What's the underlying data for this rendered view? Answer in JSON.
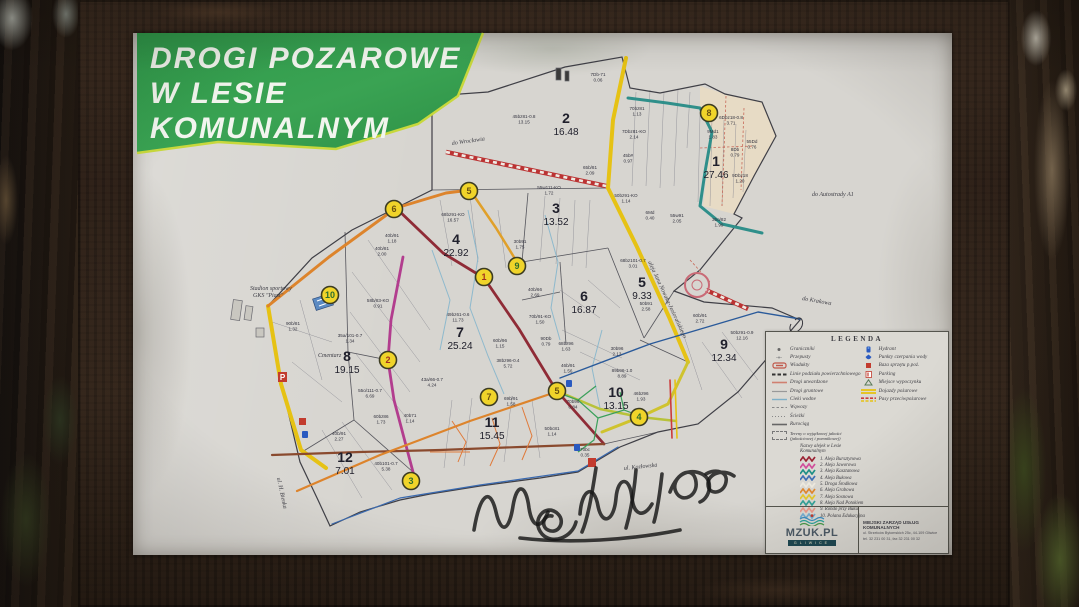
{
  "title": {
    "lines": [
      "DROGI POZAROWE",
      "W LESIE",
      "KOMUNALNYM"
    ]
  },
  "map": {
    "boundary": "488,92 565,67 622,57 630,88 660,93 705,84 725,94 762,102 776,136 754,176 734,214 742,218 700,270 674,291 704,302 772,308 800,320 770,355 738,392 698,424 658,432 620,447 578,472 540,478 480,486 430,494 400,500 360,512 330,526 318,500 300,462 282,386 268,306 312,258 352,230 396,208 432,190 432,96",
    "inner": [
      "432,190 608,188",
      "528,193 522,262",
      "522,262 608,248",
      "608,248 644,338",
      "644,338 674,291",
      "345,232 348,352",
      "348,352 354,420",
      "354,420 302,452",
      "354,420 413,472",
      "348,352 388,360",
      "522,300 560,292",
      "560,262 566,344",
      "604,444 658,432",
      "640,340 688,362"
    ],
    "mesh": [
      [
        636,
        92,
        632,
        186
      ],
      [
        650,
        90,
        646,
        186
      ],
      [
        664,
        92,
        660,
        188
      ],
      [
        678,
        90,
        674,
        186
      ],
      [
        690,
        92,
        687,
        148
      ],
      [
        700,
        115,
        698,
        202
      ],
      [
        712,
        118,
        710,
        206
      ],
      [
        724,
        120,
        722,
        206
      ],
      [
        736,
        124,
        733,
        198
      ],
      [
        746,
        130,
        743,
        192
      ],
      [
        545,
        196,
        540,
        262
      ],
      [
        560,
        198,
        556,
        264
      ],
      [
        575,
        200,
        572,
        266
      ],
      [
        590,
        200,
        586,
        268
      ],
      [
        440,
        200,
        452,
        266
      ],
      [
        470,
        196,
        478,
        262
      ],
      [
        498,
        210,
        506,
        268
      ],
      [
        368,
        240,
        430,
        330
      ],
      [
        352,
        272,
        420,
        362
      ],
      [
        350,
        312,
        410,
        392
      ],
      [
        356,
        354,
        408,
        420
      ],
      [
        300,
        300,
        322,
        380
      ],
      [
        272,
        322,
        332,
        342
      ],
      [
        292,
        362,
        342,
        402
      ],
      [
        560,
        290,
        600,
        318
      ],
      [
        588,
        280,
        620,
        308
      ],
      [
        562,
        330,
        622,
        358
      ],
      [
        580,
        352,
        640,
        380
      ],
      [
        452,
        400,
        444,
        468
      ],
      [
        472,
        398,
        464,
        466
      ],
      [
        512,
        396,
        504,
        462
      ],
      [
        532,
        400,
        540,
        458
      ],
      [
        322,
        430,
        362,
        498
      ],
      [
        342,
        422,
        392,
        490
      ],
      [
        682,
        330,
        702,
        390
      ],
      [
        702,
        342,
        742,
        398
      ],
      [
        722,
        332,
        758,
        380
      ]
    ],
    "reddash": [
      "700,148 754,146",
      "726,96 722,206",
      "744,108 741,190",
      "690,260 710,282"
    ],
    "streams": [
      "468,210 478,258 470,308 488,356 504,394",
      "545,215 558,262 551,308 560,340",
      "602,330 592,368 600,408",
      "432,250 450,300 440,350"
    ],
    "green_net": [
      "556,392 578,400 598,418 594,440 578,452",
      "598,418 624,410 648,419",
      "578,400 596,386",
      "624,410 620,392"
    ],
    "orange_net": [
      "452,421 466,442 458,462",
      "492,418 500,444 490,466",
      "522,407 532,436 522,460",
      "430,452 470,452"
    ],
    "roads": [
      {
        "name": "fire-road-east",
        "color": "#e6c214",
        "w": 4,
        "pts": "626,58 613,120 608,188"
      },
      {
        "name": "aleja-nowaka-jezioranskiego",
        "color": "#e6c214",
        "w": 4,
        "pts": "608,188 637,247 669,317 688,362"
      },
      {
        "name": "fire-road-southeast",
        "color": "#cfc32e",
        "w": 3,
        "pts": "688,362 668,404 640,417 602,432"
      },
      {
        "name": "fire-road-comp10",
        "color": "#b8c23a",
        "w": 2.5,
        "pts": "557,391 600,409 640,417 676,421"
      },
      {
        "name": "fire-road-west",
        "color": "#e6c214",
        "w": 4,
        "pts": "268,306 281,384 301,450 326,468"
      },
      {
        "name": "aleja-grabowa-nw",
        "color": "#dd842c",
        "w": 3,
        "pts": "268,306 329,257 396,208 446,193 470,190"
      },
      {
        "name": "aleja-grabowa-mid",
        "color": "#e0a02a",
        "w": 2.5,
        "pts": "470,190 496,228 517,262"
      },
      {
        "name": "aleja-bursztynowa",
        "color": "#8f2b36",
        "w": 2.8,
        "pts": "396,208 443,253 484,278 519,329 556,390 604,444"
      },
      {
        "name": "aleja-jaworowa",
        "color": "#b23d8e",
        "w": 2.8,
        "pts": "403,257 391,320 388,360 394,400 413,472"
      },
      {
        "name": "aleja-nad-potokiem",
        "color": "#2f8f8a",
        "w": 3,
        "pts": "628,98 667,103 700,108 712,132 705,172 700,206 722,224 762,233"
      },
      {
        "name": "road-south-brown",
        "color": "#8a4a2e",
        "w": 2.2,
        "pts": "272,455 360,452 440,450 520,447 604,444"
      },
      {
        "name": "aleja-grabowa-south",
        "color": "#dd842c",
        "w": 2.2,
        "pts": "297,491 380,455 470,421 556,392"
      },
      {
        "name": "pipeline-blue",
        "color": "#2a5a9a",
        "w": 1.4,
        "pts": "560,378 650,344 758,312 800,319"
      },
      {
        "name": "firebreak-east-red",
        "color": "#cc3b3b",
        "w": 1.6,
        "pts": "670,380 672,438"
      },
      {
        "name": "firebreak-east-yellow",
        "color": "#e6c214",
        "w": 1.6,
        "pts": "675,380 677,438"
      },
      {
        "name": "bottom-blue-line",
        "color": "#3a6ab0",
        "w": 1.2,
        "pts": "332,524 400,498 480,485 578,471 618,447"
      }
    ],
    "striped_roads": [
      "446,152 606,186",
      "706,290 748,309"
    ],
    "roundabout": {
      "x": 697,
      "y": 285,
      "r": 12
    },
    "comp1_fill": "700,86 725,94 762,102 776,136 754,176 734,214 703,206 707,170 712,130 700,108",
    "compartments": [
      {
        "id": "1",
        "area": "27.46",
        "x": 716,
        "y": 166
      },
      {
        "id": "2",
        "area": "16.48",
        "x": 566,
        "y": 123
      },
      {
        "id": "3",
        "area": "13.52",
        "x": 556,
        "y": 213
      },
      {
        "id": "4",
        "area": "22.92",
        "x": 456,
        "y": 244
      },
      {
        "id": "5",
        "area": "9.33",
        "x": 642,
        "y": 287
      },
      {
        "id": "6",
        "area": "16.87",
        "x": 584,
        "y": 301
      },
      {
        "id": "7",
        "area": "25.24",
        "x": 460,
        "y": 337
      },
      {
        "id": "8",
        "area": "19.15",
        "x": 347,
        "y": 361
      },
      {
        "id": "9",
        "area": "12.34",
        "x": 724,
        "y": 349
      },
      {
        "id": "10",
        "area": "13.15",
        "x": 616,
        "y": 397
      },
      {
        "id": "11",
        "area": "15.45",
        "x": 492,
        "y": 427
      },
      {
        "id": "12",
        "area": "7.01",
        "x": 345,
        "y": 462
      }
    ],
    "waypoints": [
      {
        "n": "6",
        "x": 394,
        "y": 209,
        "tc": "#6a5210"
      },
      {
        "n": "5",
        "x": 469,
        "y": 191,
        "tc": "#6a5210"
      },
      {
        "n": "1",
        "x": 484,
        "y": 277,
        "tc": "#a33020"
      },
      {
        "n": "9",
        "x": 517,
        "y": 266,
        "tc": "#2e6e2e"
      },
      {
        "n": "10",
        "x": 330,
        "y": 295,
        "tc": "#2e6e2e"
      },
      {
        "n": "2",
        "x": 388,
        "y": 360,
        "tc": "#a33020"
      },
      {
        "n": "3",
        "x": 411,
        "y": 481,
        "tc": "#2e6e2e"
      },
      {
        "n": "7",
        "x": 489,
        "y": 397,
        "tc": "#6a5210"
      },
      {
        "n": "5",
        "x": 557,
        "y": 391,
        "tc": "#6a5210"
      },
      {
        "n": "4",
        "x": 639,
        "y": 417,
        "tc": "#2e6e2e"
      },
      {
        "n": "8",
        "x": 709,
        "y": 113,
        "tc": "#6a5210"
      }
    ],
    "labels": [
      {
        "t": "do Wrocławia",
        "x": 452,
        "y": 145,
        "r": -8,
        "fs": 6
      },
      {
        "t": "do Autostrady A1",
        "x": 812,
        "y": 196,
        "r": 0,
        "fs": 6
      },
      {
        "t": "do Krakowa",
        "x": 802,
        "y": 300,
        "r": 10,
        "fs": 6
      },
      {
        "t": "aleja Jana Nowaka-Jeziorańskiego",
        "x": 648,
        "y": 262,
        "r": 65,
        "fs": 4.6
      },
      {
        "t": "Cmentarz",
        "x": 318,
        "y": 357,
        "r": 0,
        "fs": 5.5
      },
      {
        "t": "Stadion sportowy",
        "x": 250,
        "y": 290,
        "r": 0,
        "fs": 5
      },
      {
        "t": "GKS \"Piast\"",
        "x": 253,
        "y": 297,
        "r": 0,
        "fs": 5
      },
      {
        "t": "ul. H. Bienka",
        "x": 277,
        "y": 478,
        "r": 78,
        "fs": 4.5
      },
      {
        "t": "ul. Kozłowska",
        "x": 624,
        "y": 470,
        "r": -6,
        "fs": 4.5
      }
    ],
    "parcels": [
      {
        "c": "7Db-71",
        "a": "0.06",
        "x": 598,
        "y": 76
      },
      {
        "c": "45bz81-0.8",
        "a": "13.15",
        "x": 524,
        "y": 118
      },
      {
        "c": "70bz81",
        "a": "1.13",
        "x": 637,
        "y": 110
      },
      {
        "c": "7Dbz81-KO",
        "a": "2.14",
        "x": 634,
        "y": 133
      },
      {
        "c": "45b#",
        "a": "0.97",
        "x": 628,
        "y": 157
      },
      {
        "c": "65b/81",
        "a": "2.09",
        "x": 590,
        "y": 169
      },
      {
        "c": "6Dbz18-0.8",
        "a": "3.71",
        "x": 731,
        "y": 119
      },
      {
        "c": "9Md1",
        "a": "1.83",
        "x": 713,
        "y": 133
      },
      {
        "c": "55Dd",
        "a": "0.76",
        "x": 752,
        "y": 143
      },
      {
        "c": "8Db",
        "a": "0.79",
        "x": 735,
        "y": 151
      },
      {
        "c": "9Dbz18",
        "a": "1.20",
        "x": 740,
        "y": 177
      },
      {
        "c": "55w111-KO",
        "a": "1.72",
        "x": 549,
        "y": 189
      },
      {
        "c": "50bz91-KO",
        "a": "1.14",
        "x": 626,
        "y": 197
      },
      {
        "c": "6Md",
        "a": "0.40",
        "x": 650,
        "y": 214
      },
      {
        "c": "55w91",
        "a": "2.05",
        "x": 677,
        "y": 217
      },
      {
        "c": "35o/82",
        "a": "1.99",
        "x": 719,
        "y": 221
      },
      {
        "c": "68bz91-KO",
        "a": "16.57",
        "x": 453,
        "y": 216
      },
      {
        "c": "40b/91",
        "a": "1.18",
        "x": 392,
        "y": 237
      },
      {
        "c": "40b/81",
        "a": "2.00",
        "x": 382,
        "y": 250
      },
      {
        "c": "30b91",
        "a": "1.75",
        "x": 520,
        "y": 243
      },
      {
        "c": "68bz101-0.7",
        "a": "3.01",
        "x": 633,
        "y": 262
      },
      {
        "c": "50b91",
        "a": "2.58",
        "x": 646,
        "y": 305
      },
      {
        "c": "40b/66",
        "a": "2.69",
        "x": 535,
        "y": 291
      },
      {
        "c": "70b/91-KO",
        "a": "1.50",
        "x": 540,
        "y": 318
      },
      {
        "c": "90Db",
        "a": "0.79",
        "x": 546,
        "y": 340
      },
      {
        "c": "68bz96",
        "a": "1.63",
        "x": 566,
        "y": 345
      },
      {
        "c": "46b/91",
        "a": "1.56",
        "x": 568,
        "y": 367
      },
      {
        "c": "30b96",
        "a": "2.13",
        "x": 617,
        "y": 350
      },
      {
        "c": "89b96-1.0",
        "a": "8.89",
        "x": 622,
        "y": 372
      },
      {
        "c": "49bz61-0.6",
        "a": "11.73",
        "x": 458,
        "y": 316
      },
      {
        "c": "60b/96",
        "a": "1.15",
        "x": 500,
        "y": 342
      },
      {
        "c": "38bz96-0.4",
        "a": "5.72",
        "x": 508,
        "y": 362
      },
      {
        "c": "43a/66-0.7",
        "a": "4.24",
        "x": 432,
        "y": 381
      },
      {
        "c": "90b/81",
        "a": "1.32",
        "x": 293,
        "y": 325
      },
      {
        "c": "58b/83-KO",
        "a": "0.91",
        "x": 378,
        "y": 302
      },
      {
        "c": "35a/101-0.7",
        "a": "1.34",
        "x": 350,
        "y": 337
      },
      {
        "c": "55o/111-0.7",
        "a": "6.69",
        "x": 370,
        "y": 392
      },
      {
        "c": "60b/91",
        "a": "2.72",
        "x": 700,
        "y": 317
      },
      {
        "c": "50bz91-0.9",
        "a": "12.16",
        "x": 742,
        "y": 334
      },
      {
        "c": "46bz96",
        "a": "1.93",
        "x": 641,
        "y": 395
      },
      {
        "c": "70b96",
        "a": "0.84",
        "x": 573,
        "y": 403
      },
      {
        "c": "69b/91",
        "a": "1.58",
        "x": 511,
        "y": 400
      },
      {
        "c": "50bc81",
        "a": "1.14",
        "x": 552,
        "y": 430
      },
      {
        "c": "70bc",
        "a": "0.35",
        "x": 585,
        "y": 451
      },
      {
        "c": "60bz86",
        "a": "1.73",
        "x": 381,
        "y": 418
      },
      {
        "c": "40b71",
        "a": "1.14",
        "x": 410,
        "y": 417
      },
      {
        "c": "40b/91",
        "a": "2.27",
        "x": 339,
        "y": 435
      },
      {
        "c": "40b101-0.7",
        "a": "5.38",
        "x": 386,
        "y": 465
      }
    ],
    "graffiti": [
      "M474,530 c6,-36 16,-44 22,-18 c5,22 13,20 17,-6 c4,-24 13,-22 16,2 c3,20 12,22 19,4",
      "M552,516 c-8,-2 -12,10 -4,14 c10,5 18,-8 10,-16 c-12,-12 -28,6 -16,20 c10,11 30,4 34,-12",
      "M580,514 c2,-26 14,-30 18,-8 c4,20 16,16 18,-8 c2,-22 14,-22 16,0 c2,18 12,20 20,6",
      "M596,468 c-4,26 -8,50 -14,64 M636,470 c-2,24 -6,44 -10,58 M662,474 c-2,18 -4,34 -8,48",
      "M670,492 c8,-22 24,-26 26,-10 c2,14 -14,22 -20,10 c-6,-12 10,-26 26,-18 c12,6 8,24 -2,28",
      "M706,474 c10,-6 22,-2 20,8 c-2,12 -18,14 -18,2 c0,-10 14,-16 26,-8",
      "M520,538 c50,6 110,2 160,-8"
    ]
  },
  "legend": {
    "title": "LEGENDA",
    "left_items": [
      {
        "sym": "dot",
        "label": "Graniczniki"
      },
      {
        "sym": "smalldot",
        "label": "Przepusty"
      },
      {
        "sym": "bracket",
        "label": "Wiadukty"
      },
      {
        "sym": "dashbold",
        "label": "Linie podziału powierzchniowego"
      },
      {
        "sym": "linered",
        "label": "Drogi utwardzone"
      },
      {
        "sym": "linegray",
        "label": "Drogi gruntowe"
      },
      {
        "sym": "lineblue",
        "label": "Cieki wodne"
      },
      {
        "sym": "dashgray",
        "label": "Wąwozy"
      },
      {
        "sym": "dotsgray",
        "label": "Ścieżki"
      },
      {
        "sym": "linedark",
        "label": "Rurociąg"
      }
    ],
    "right_items": [
      {
        "sym": "hydrant",
        "label": "Hydrant"
      },
      {
        "sym": "water",
        "label": "Punkty czerpania wody"
      },
      {
        "sym": "redbox",
        "label": "Baza sprzętu p.poż."
      },
      {
        "sym": "parking",
        "label": "Parking"
      },
      {
        "sym": "rest",
        "label": "Miejsce wypoczynku"
      },
      {
        "sym": "yellowlines",
        "label": "Dojazdy pożarowe"
      },
      {
        "sym": "redyellow",
        "label": "Pasy przeciwpożarowe"
      }
    ],
    "note_line1": "Tereny o wyjątkowej jakości",
    "note_line2": "(jakościowej i pomnikowej)",
    "streets_header1": "Nazwy alejek w Lesie",
    "streets_header2": "Komunalnym",
    "streets": [
      {
        "n": "1.",
        "name": "Aleja Bursztynowa",
        "color": "#9b2335"
      },
      {
        "n": "2.",
        "name": "Aleja Jaworowa",
        "color": "#d14f9b"
      },
      {
        "n": "3.",
        "name": "Aleja Kasztanowa",
        "color": "#1f8f86"
      },
      {
        "n": "4.",
        "name": "Aleja Bukowa",
        "color": "#3f6fb5"
      },
      {
        "n": "5.",
        "name": "Droga Środkowa",
        "color": "#efebe0"
      },
      {
        "n": "6.",
        "name": "Aleja Grabowa",
        "color": "#e2882f"
      },
      {
        "n": "7.",
        "name": "Aleja Sosnowa",
        "color": "#e6c92e"
      },
      {
        "n": "8.",
        "name": "Aleja Nad Potokiem",
        "color": "#35a39a"
      },
      {
        "n": "9.",
        "name": "Rondo przy Buku",
        "color": "#eb9a8d"
      },
      {
        "n": "10.",
        "name": "Polana Edukacyjna",
        "color": "#76aed2"
      }
    ],
    "footer": {
      "logo_text": "MZUK.PL",
      "logo_band": "GLIWICE",
      "org_name": "MIEJSKI ZARZĄD USŁUG KOMUNALNYCH",
      "org_line1": "ul. Strzelców Bytomskich 25c, 44-109 Gliwice",
      "org_line2": "tel. 32 231 00 31, fax 32 231 00 32"
    }
  }
}
